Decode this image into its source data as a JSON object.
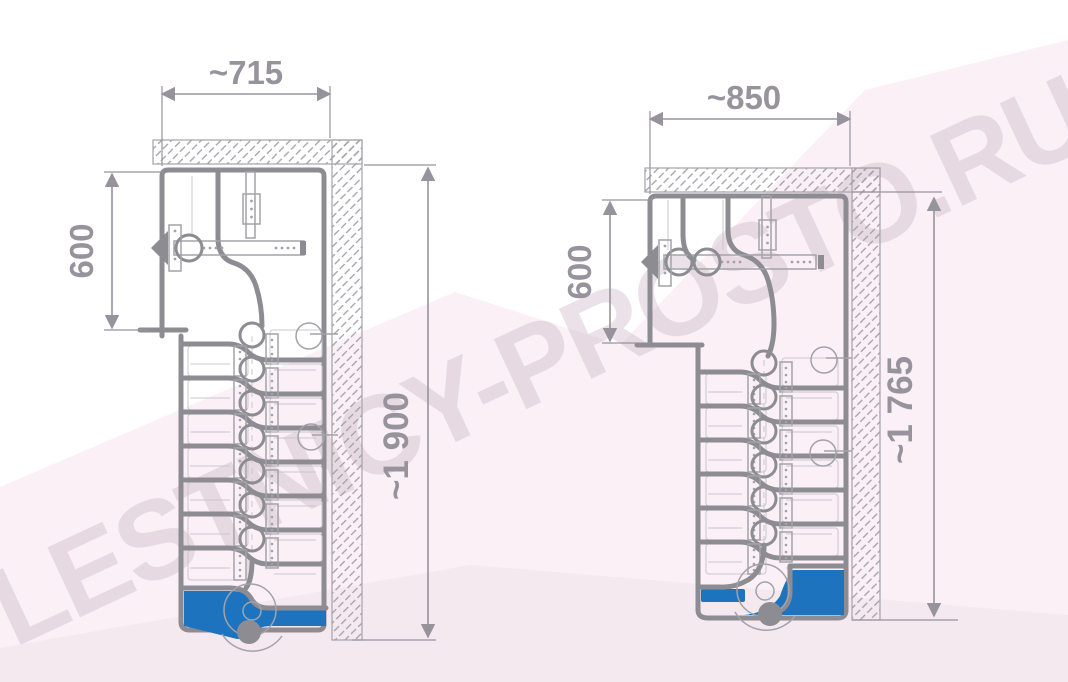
{
  "watermark": {
    "text": "LESTNICY-PROSTO.RU"
  },
  "drawings": {
    "left": {
      "name": "goose-step staircase plan, narrow variant",
      "width_label": "~715",
      "flight_width_label": "600",
      "height_label": "~1 900"
    },
    "right": {
      "name": "goose-step staircase plan, wide variant",
      "width_label": "~850",
      "flight_width_label": "600",
      "height_label": "~1 765"
    }
  },
  "colors": {
    "blue": "#1e73be",
    "thick": "#8d8c93",
    "thin": "#a3a2a9",
    "light": "#c9c8cf",
    "dim": "#97939c",
    "hatch": "#a09fa6",
    "pink": "#faf0f6",
    "pink2": "#f5e9f0",
    "wm": "#c9b3c3",
    "bg": "#ffffff"
  }
}
